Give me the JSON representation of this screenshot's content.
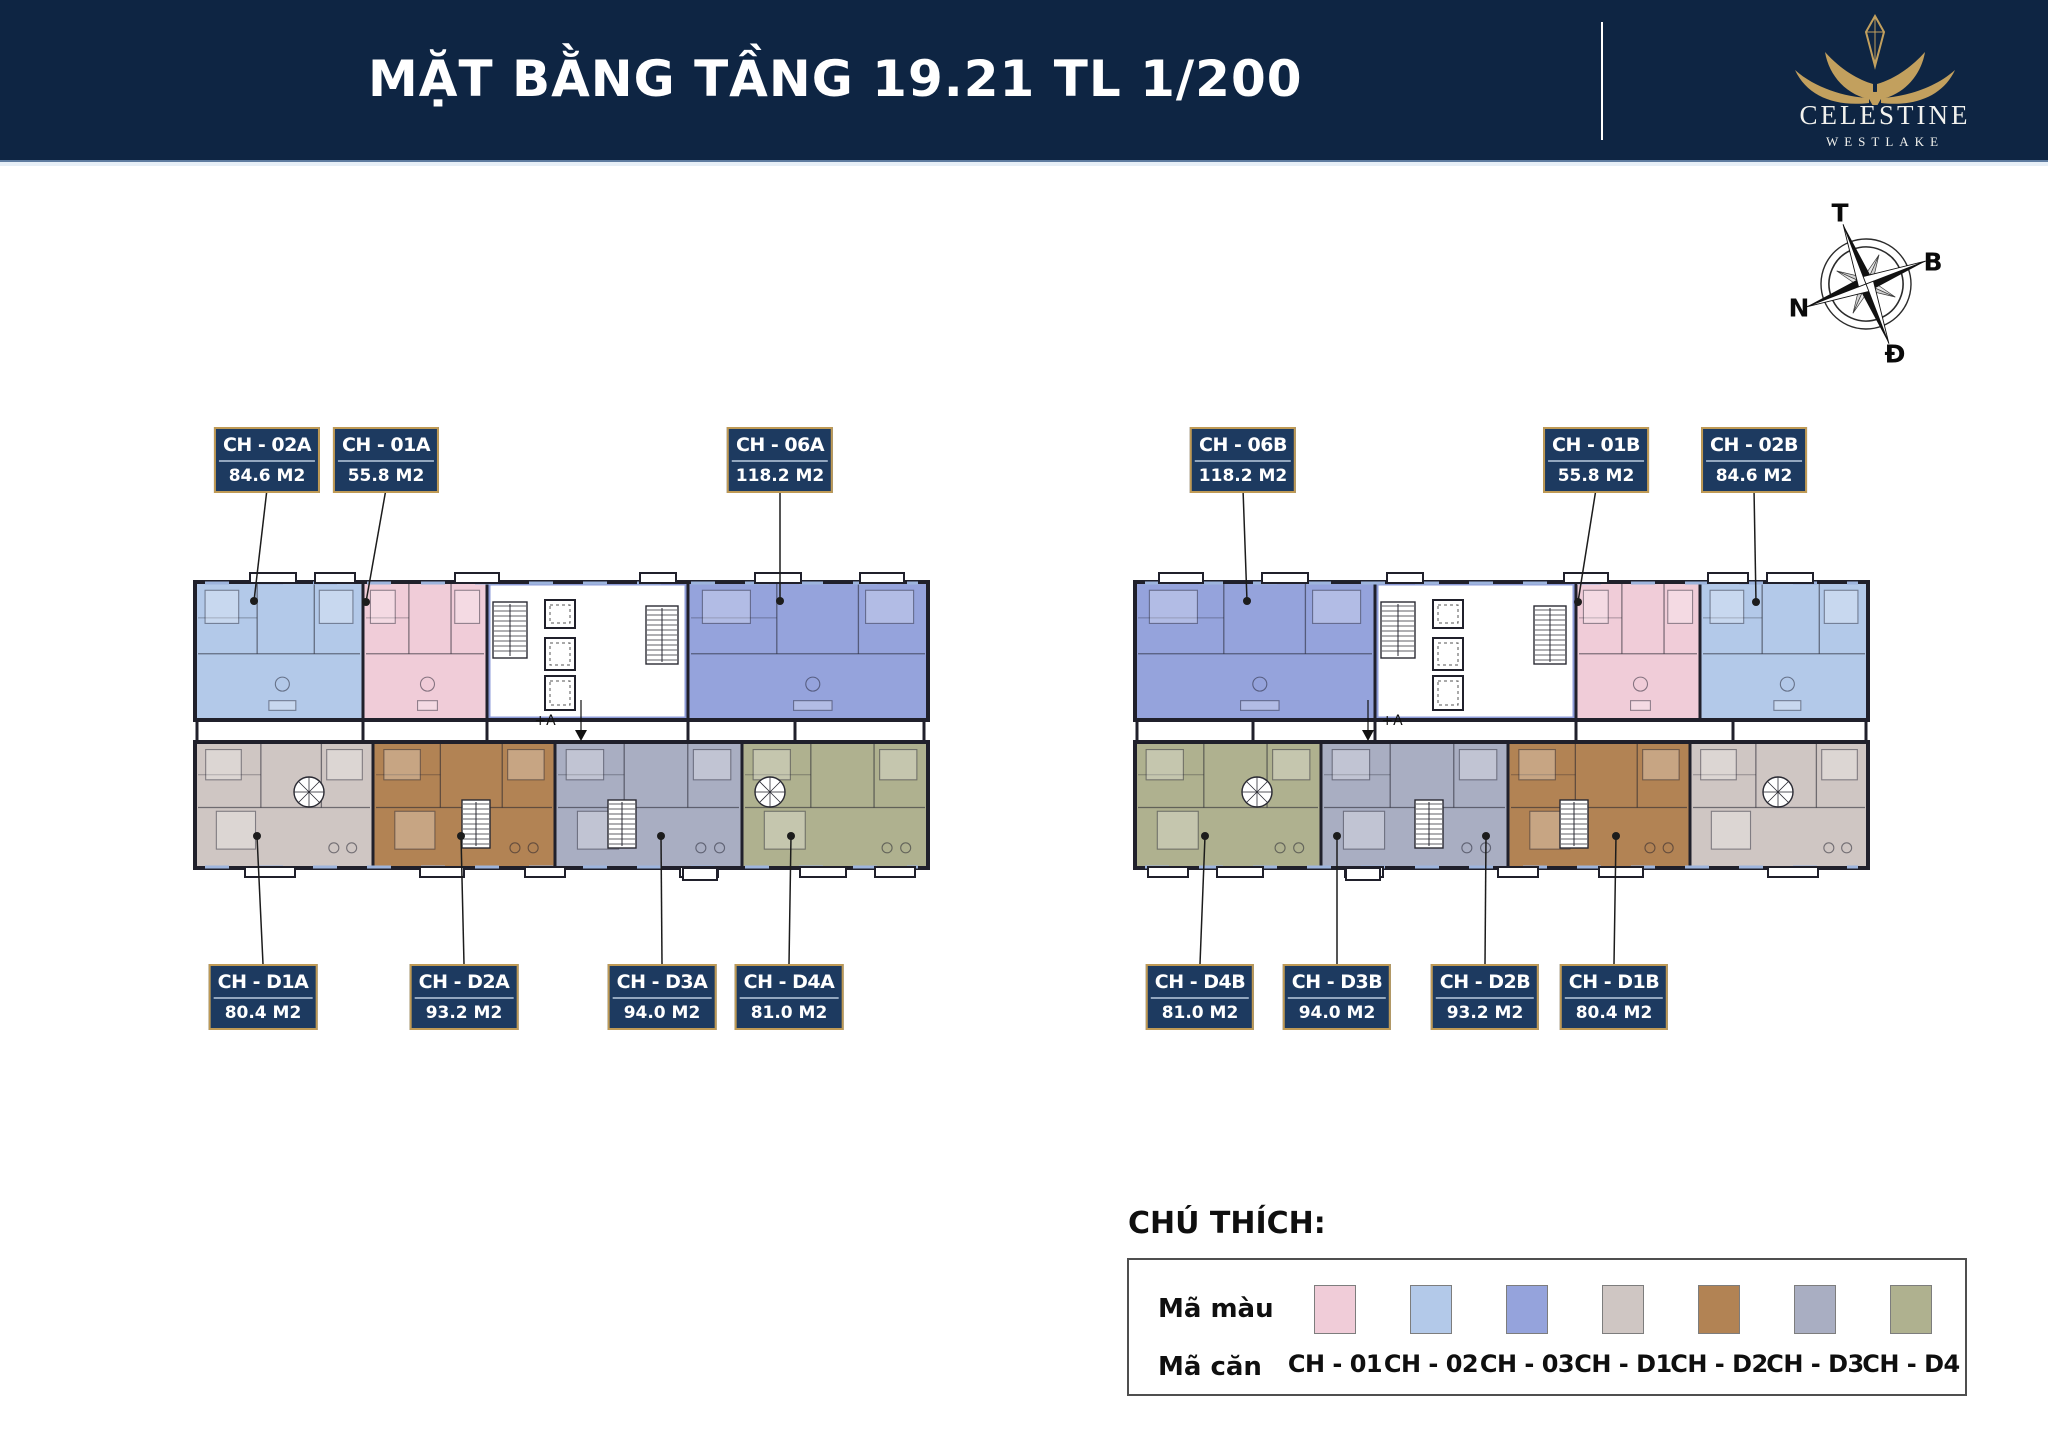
{
  "header": {
    "title": "MẶT BẰNG TẦNG 19.21 TL 1/200",
    "bg": "#0e2543",
    "brand": {
      "name": "CELESTINE",
      "sub": "WESTLAKE"
    }
  },
  "compass": {
    "top": "T",
    "right": "B",
    "left": "N",
    "bottom": "Đ"
  },
  "palette": {
    "wall": "#20202b",
    "core_wall": "#8d9bd8",
    "window": "#9db4dd",
    "gold": "#c2a05e",
    "pink": "#f0ccd8",
    "lightblue": "#b3c9e9",
    "periwinkle": "#95a3dc",
    "beige": "#cfc6c3",
    "brown": "#b28354",
    "grayblue": "#a9aec2",
    "olive": "#afb18f"
  },
  "unit_label_rows": {
    "top_y": 427,
    "bottom_y": 964,
    "box_h": 62
  },
  "units": [
    {
      "code": "CH - 02A",
      "area": "84.6 M2",
      "row": "top",
      "cx": 267,
      "dot": [
        254,
        601
      ]
    },
    {
      "code": "CH - 01A",
      "area": "55.8 M2",
      "row": "top",
      "cx": 386,
      "dot": [
        366,
        602
      ]
    },
    {
      "code": "CH - 06A",
      "area": "118.2 M2",
      "row": "top",
      "cx": 780,
      "dot": [
        780,
        601
      ]
    },
    {
      "code": "CH - 06B",
      "area": "118.2 M2",
      "row": "top",
      "cx": 1243,
      "dot": [
        1247,
        601
      ]
    },
    {
      "code": "CH - 01B",
      "area": "55.8 M2",
      "row": "top",
      "cx": 1596,
      "dot": [
        1578,
        602
      ]
    },
    {
      "code": "CH - 02B",
      "area": "84.6 M2",
      "row": "top",
      "cx": 1754,
      "dot": [
        1756,
        602
      ]
    },
    {
      "code": "CH - D1A",
      "area": "80.4 M2",
      "row": "bottom",
      "cx": 263,
      "dot": [
        257,
        836
      ]
    },
    {
      "code": "CH - D2A",
      "area": "93.2 M2",
      "row": "bottom",
      "cx": 464,
      "dot": [
        461,
        836
      ]
    },
    {
      "code": "CH - D3A",
      "area": "94.0 M2",
      "row": "bottom",
      "cx": 662,
      "dot": [
        661,
        836
      ]
    },
    {
      "code": "CH - D4A",
      "area": "81.0 M2",
      "row": "bottom",
      "cx": 789,
      "dot": [
        791,
        836
      ]
    },
    {
      "code": "CH - D4B",
      "area": "81.0 M2",
      "row": "bottom",
      "cx": 1200,
      "dot": [
        1205,
        836
      ]
    },
    {
      "code": "CH - D3B",
      "area": "94.0 M2",
      "row": "bottom",
      "cx": 1337,
      "dot": [
        1337,
        836
      ]
    },
    {
      "code": "CH - D2B",
      "area": "93.2 M2",
      "row": "bottom",
      "cx": 1485,
      "dot": [
        1486,
        836
      ]
    },
    {
      "code": "CH - D1B",
      "area": "80.4 M2",
      "row": "bottom",
      "cx": 1614,
      "dot": [
        1616,
        836
      ]
    }
  ],
  "buildings": [
    {
      "id": "A",
      "upper": {
        "x": 195,
        "y": 582,
        "w": 733,
        "h": 138,
        "sections": [
          {
            "color": "lightblue",
            "x": 195,
            "w": 168
          },
          {
            "color": "pink",
            "x": 363,
            "w": 124
          },
          {
            "core": true,
            "x": 487,
            "w": 201
          },
          {
            "color": "periwinkle",
            "x": 688,
            "w": 240
          }
        ],
        "tabs": [
          [
            250,
            46
          ],
          [
            315,
            40
          ],
          [
            455,
            44
          ],
          [
            640,
            36
          ],
          [
            755,
            46
          ],
          [
            860,
            44
          ]
        ]
      },
      "lower": {
        "x": 195,
        "y": 742,
        "w": 733,
        "h": 126,
        "sections": [
          {
            "color": "beige",
            "x": 195,
            "w": 178,
            "spiral": 297
          },
          {
            "color": "brown",
            "x": 373,
            "w": 182,
            "stair": 462
          },
          {
            "color": "grayblue",
            "x": 555,
            "w": 187,
            "stair": 608
          },
          {
            "color": "olive",
            "x": 742,
            "w": 186,
            "spiral": 758
          }
        ],
        "tabs": [
          [
            245,
            50
          ],
          [
            420,
            44
          ],
          [
            525,
            40
          ],
          [
            680,
            38
          ],
          [
            800,
            46
          ],
          [
            875,
            40
          ]
        ],
        "notch": [
          683,
          34
        ]
      },
      "gap_walls": [
        197,
        363,
        487,
        688,
        795,
        924
      ],
      "marker": {
        "label": "+A",
        "label_x": 545,
        "arrow_x": 581
      }
    },
    {
      "id": "B",
      "upper": {
        "x": 1135,
        "y": 582,
        "w": 733,
        "h": 138,
        "sections": [
          {
            "color": "periwinkle",
            "x": 1135,
            "w": 240
          },
          {
            "core": true,
            "x": 1375,
            "w": 201
          },
          {
            "color": "pink",
            "x": 1576,
            "w": 124
          },
          {
            "color": "lightblue",
            "x": 1700,
            "w": 168
          }
        ],
        "tabs": [
          [
            1159,
            44
          ],
          [
            1262,
            46
          ],
          [
            1387,
            36
          ],
          [
            1564,
            44
          ],
          [
            1708,
            40
          ],
          [
            1767,
            46
          ]
        ]
      },
      "lower": {
        "x": 1135,
        "y": 742,
        "w": 733,
        "h": 126,
        "sections": [
          {
            "color": "olive",
            "x": 1135,
            "w": 186,
            "spiral": 1245
          },
          {
            "color": "grayblue",
            "x": 1321,
            "w": 187,
            "stair": 1415
          },
          {
            "color": "brown",
            "x": 1508,
            "w": 182,
            "stair": 1560
          },
          {
            "color": "beige",
            "x": 1690,
            "w": 178,
            "spiral": 1766
          }
        ],
        "tabs": [
          [
            1148,
            40
          ],
          [
            1217,
            46
          ],
          [
            1345,
            38
          ],
          [
            1498,
            40
          ],
          [
            1599,
            44
          ],
          [
            1768,
            50
          ]
        ],
        "notch": [
          1346,
          34
        ]
      },
      "gap_walls": [
        1137,
        1253,
        1375,
        1576,
        1733,
        1866
      ],
      "marker": {
        "label": "+A",
        "label_x": 1392,
        "arrow_x": 1368
      }
    }
  ],
  "legend": {
    "title": "CHÚ THÍCH:",
    "color_row_label": "Mã màu",
    "unit_row_label": "Mã căn",
    "item_start": 1287,
    "item_pitch": 96,
    "swatch": {
      "w": 40,
      "h": 47,
      "y": 1285
    },
    "code_y": 1350,
    "items": [
      {
        "code": "CH - 01",
        "color_key": "pink"
      },
      {
        "code": "CH - 02",
        "color_key": "lightblue"
      },
      {
        "code": "CH - 03",
        "color_key": "periwinkle"
      },
      {
        "code": "CH - D1",
        "color_key": "beige"
      },
      {
        "code": "CH - D2",
        "color_key": "brown"
      },
      {
        "code": "CH - D3",
        "color_key": "grayblue"
      },
      {
        "code": "CH - D4",
        "color_key": "olive"
      }
    ]
  }
}
